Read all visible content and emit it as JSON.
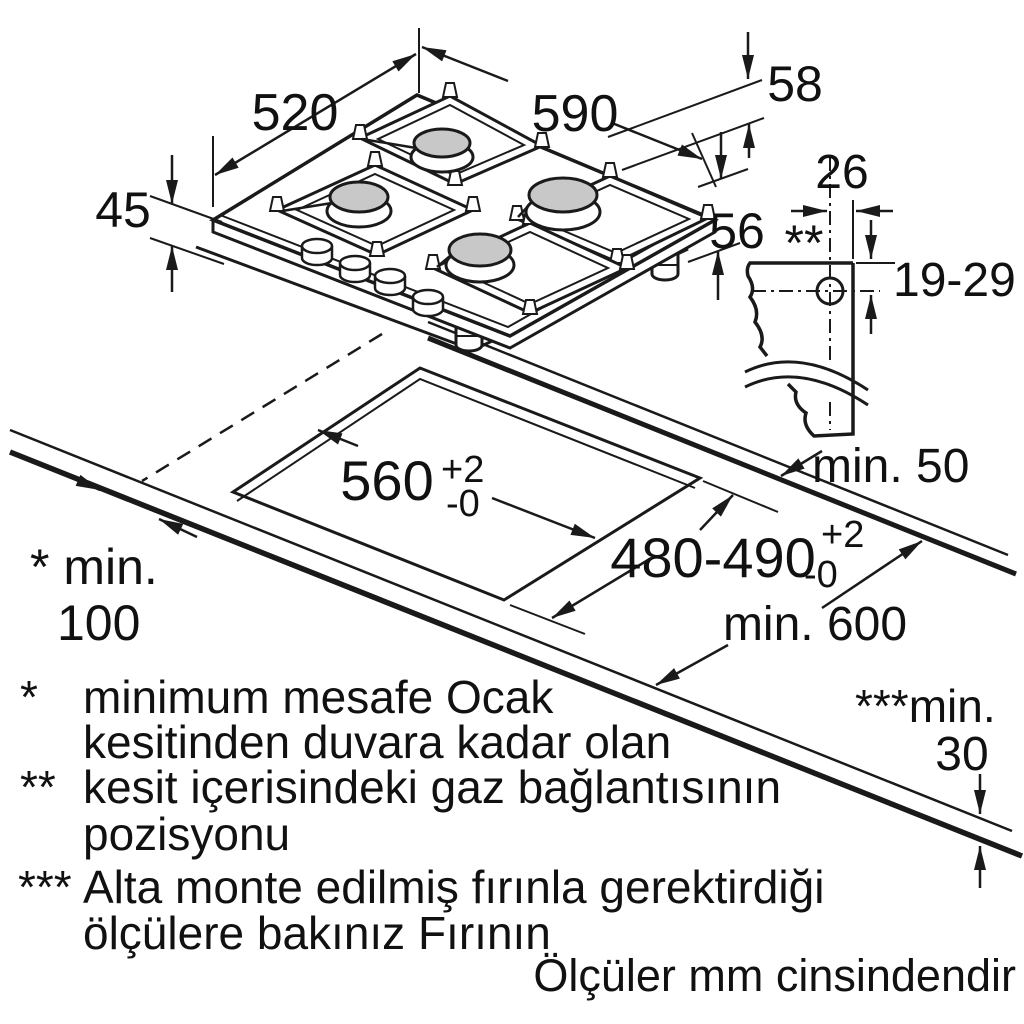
{
  "diagram": {
    "dims": {
      "width_top": "520",
      "width_front": "590",
      "height_58": "58",
      "height_45": "45",
      "height_56": "56",
      "gas_offset": "26",
      "gas_marker": "**",
      "gas_height_range": "19-29",
      "clearance_back": "min. 50",
      "cutout_width": "560",
      "tol_plus": "+2",
      "tol_minus": "-0",
      "cutout_depth": "480-490",
      "wall_marker_label": "* min.",
      "wall_clearance": "100",
      "worktop_depth": "min. 600",
      "oven_marker_label": "***min.",
      "oven_clearance": "30"
    },
    "footnotes": [
      {
        "marker": "*",
        "text1": "minimum mesafe Ocak",
        "text2": "kesitinden duvara kadar olan"
      },
      {
        "marker": "**",
        "text1": "kesit içerisindeki gaz bağlantısının",
        "text2": "pozisyonu"
      },
      {
        "marker": "***",
        "text1": "Alta monte edilmiş fırınla gerektirdiği",
        "text2": "ölçülere bakınız Fırının"
      }
    ],
    "units_note": "Ölçüler mm cinsindendir",
    "colors": {
      "line": "#1a1a1a",
      "burner_cap": "#c8c8c8",
      "background": "#ffffff"
    }
  }
}
